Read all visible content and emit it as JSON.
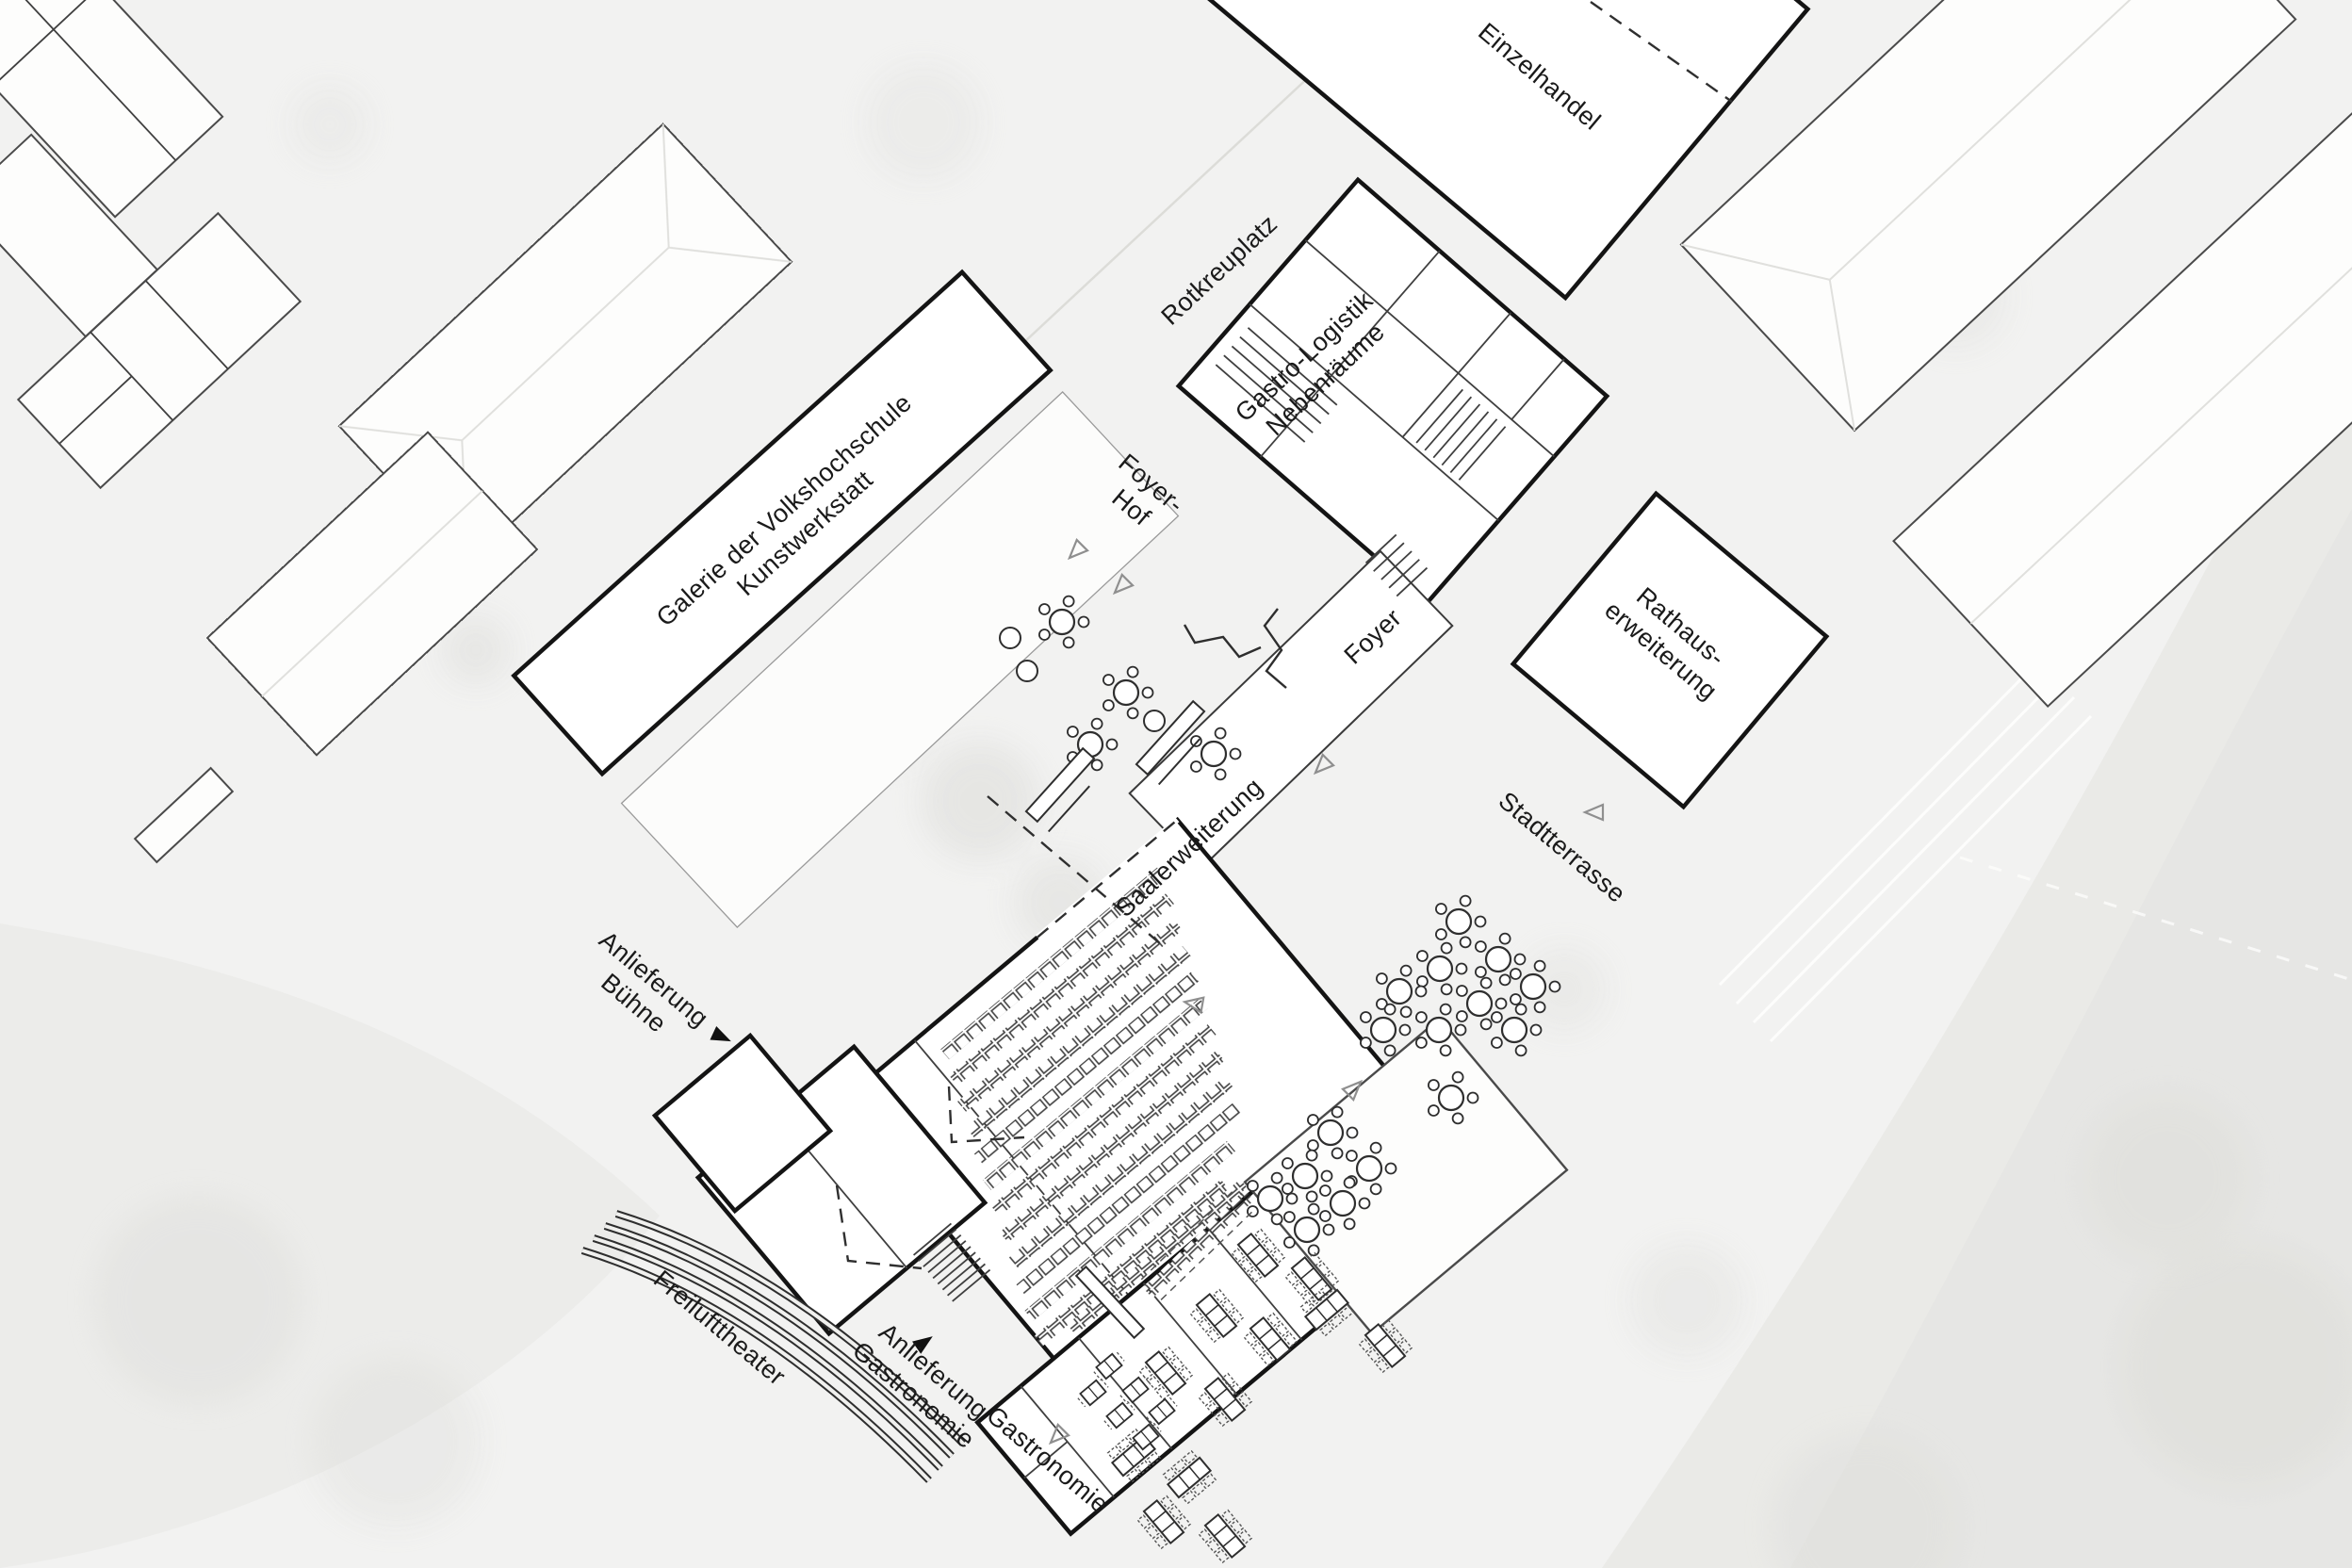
{
  "plan": {
    "type": "architectural-site-plan",
    "labels": {
      "einzelhandel": {
        "text": "Einzelhandel"
      },
      "rotkreuplatz": {
        "text": "Rotkreuplatz"
      },
      "gastro_logistik": {
        "line1": "Gastro-Logistik",
        "line2": "Nebenräume"
      },
      "foyer_hof": {
        "line1": "Foyer-",
        "line2": "Hof"
      },
      "galerie": {
        "line1": "Galerie der Volkshochschule",
        "line2": "Kunstwerkstatt"
      },
      "foyer": {
        "text": "Foyer"
      },
      "rathaus": {
        "line1": "Rathaus-",
        "line2": "erweiterung"
      },
      "stadtterrasse": {
        "text": "Stadtterrasse"
      },
      "saalerweiterung": {
        "text": "Saalerweiterung"
      },
      "anlieferung_buehne": {
        "line1": "Anlieferung",
        "line2": "Bühne"
      },
      "freilufttheater": {
        "text": "Freilufttheater"
      },
      "anlieferung_gastronomie": {
        "line1": "Anlieferung",
        "line2": "Gastronomie"
      },
      "gastronomie": {
        "text": "Gastronomie"
      }
    },
    "icons": {
      "door_arrow": "hollow-triangle",
      "delivery_arrow": "filled-triangle",
      "round_table": "circle-with-chairs",
      "rect_table": "rectangle-with-dashed-chairs",
      "seat_row": "row-of-squares",
      "amphitheatre": "concentric-arcs",
      "stairs": "parallel-hatch-lines"
    },
    "colors": {
      "background": "#f2f2f1",
      "building_outline_bold": "#141414",
      "building_outline_thin": "#4a4a4a",
      "building_fill": "#ffffff",
      "text": "#1a1a1a",
      "water_wash": "#e9e9e6",
      "vegetation_wash": "#d8d8d4"
    }
  }
}
